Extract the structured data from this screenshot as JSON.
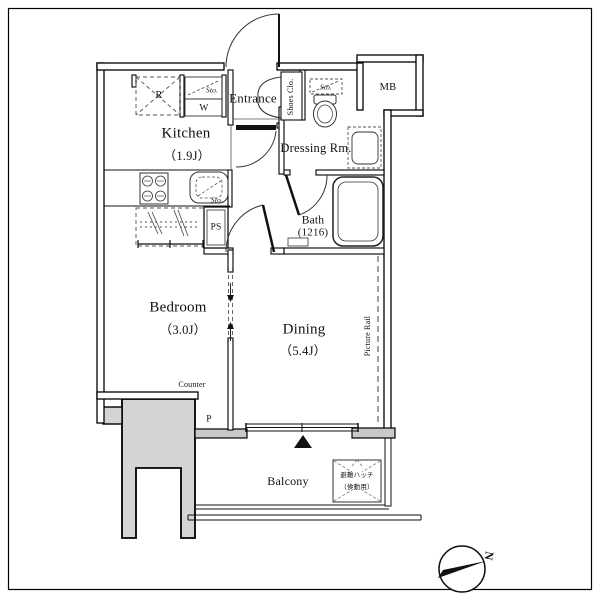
{
  "page": {
    "type": "apartment-floor-plan"
  },
  "rooms": {
    "kitchen": {
      "name": "Kitchen",
      "size": "（1.9J）"
    },
    "entrance": {
      "name": "Entrance"
    },
    "shoes_closet": {
      "name": "Shoes Clo."
    },
    "dressing_room": {
      "name": "Dressing Rm."
    },
    "bath": {
      "name": "Bath",
      "size": "(1216)"
    },
    "bedroom": {
      "name": "Bedroom",
      "size": "（3.0J）"
    },
    "dining": {
      "name": "Dining",
      "size": "（5.4J）"
    },
    "balcony": {
      "name": "Balcony"
    }
  },
  "fixtures": {
    "meter_box": "MB",
    "pipe_space": "PS",
    "refrigerator": "R",
    "washer": "W",
    "storage_shelf": "Sto.",
    "storage_sink": "Sto.",
    "storage_toilet": "Sto.",
    "picture_rail": "Picture Rail",
    "counter": "Counter",
    "pipe": "P",
    "hatch_line1": "避難ハッチ",
    "hatch_line2": "（倹動用）",
    "compass_north": "N"
  },
  "colors": {
    "line": "#111111",
    "common_area": "#d4d4d4",
    "background": "#ffffff"
  }
}
